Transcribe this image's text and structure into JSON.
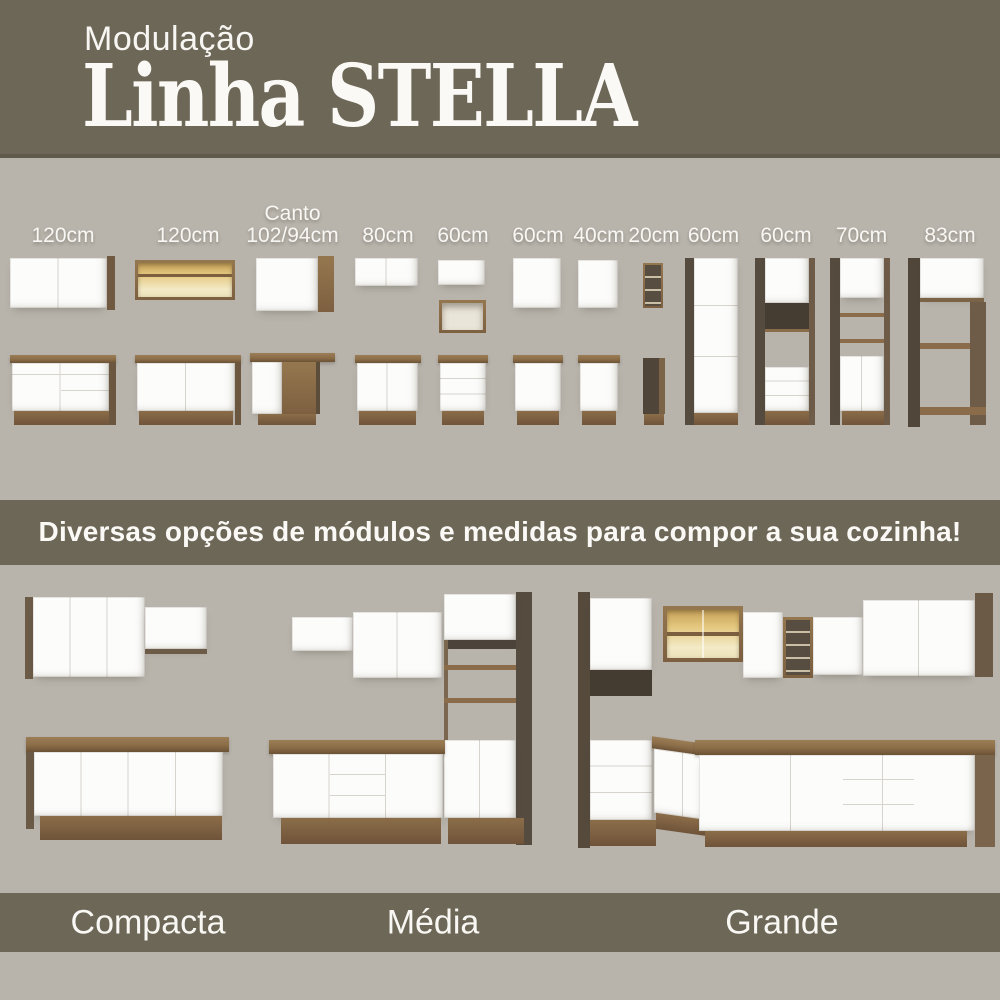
{
  "header": {
    "kicker": "Modulação",
    "title": "Linha STELLA"
  },
  "modules": {
    "items": [
      {
        "label": "120cm"
      },
      {
        "label": "120cm"
      },
      {
        "label": "Canto\n102/94cm"
      },
      {
        "label": "80cm"
      },
      {
        "label": "60cm"
      },
      {
        "label": "60cm"
      },
      {
        "label": "40cm"
      },
      {
        "label": "20cm"
      },
      {
        "label": "60cm"
      },
      {
        "label": "60cm"
      },
      {
        "label": "70cm"
      },
      {
        "label": "83cm"
      }
    ]
  },
  "divider": {
    "text": "Diversas opções de módulos e medidas para compor a sua cozinha!"
  },
  "kitchens": {
    "items": [
      {
        "name": "Compacta"
      },
      {
        "name": "Média"
      },
      {
        "name": "Grande"
      }
    ]
  },
  "colors": {
    "banner": "#6d6757",
    "background": "#b8b4ac",
    "wood": "#8a6c47",
    "wood_dark": "#554b3e",
    "cabinet_white": "#fcfcfb",
    "glass_glow": "#e4c87f",
    "text": "#f8f7f3"
  }
}
